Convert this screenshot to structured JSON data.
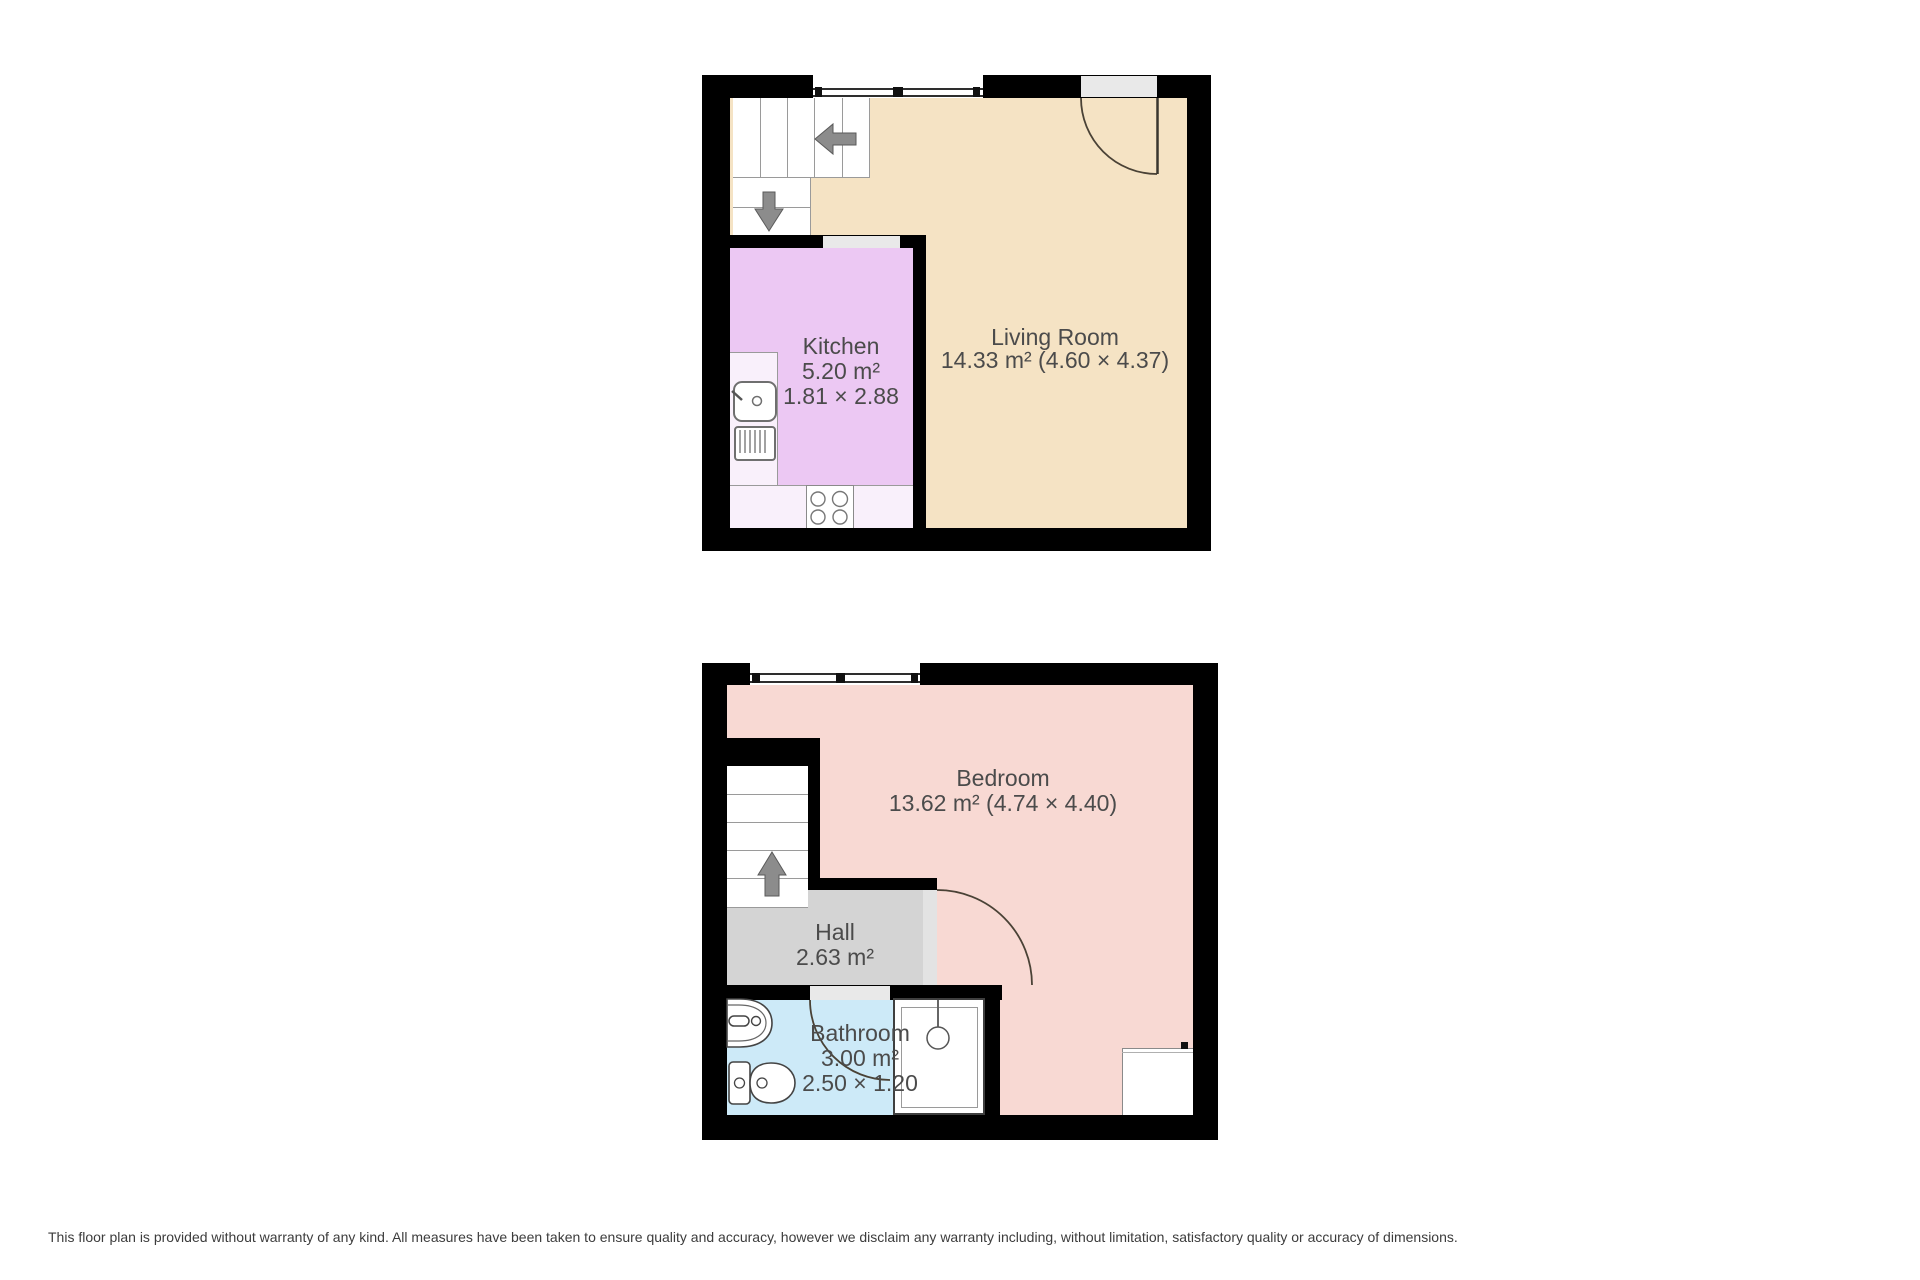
{
  "page": {
    "background": "#ffffff",
    "disclaimer": "This floor plan is provided without warranty of any kind. All measures have been taken to ensure quality and accuracy, however we disclaim any warranty including, without limitation, satisfactory quality or accuracy of dimensions."
  },
  "colors": {
    "wall": "#000000",
    "living_room": "#f5e3c4",
    "kitchen": "#ecc8f3",
    "kitchen_counter": "#f9f0fb",
    "bedroom": "#f8d9d3",
    "hall": "#d4d4d4",
    "bathroom": "#cdeaf8",
    "door_opening": "#e9e9e9",
    "door_leaf": "#e3e3e3",
    "label_text": "#4b4b4b",
    "arrow": "#8c8c8c"
  },
  "floor_upper": {
    "rooms": [
      {
        "name": "Kitchen",
        "area": "5.20 m²",
        "dims": "1.81 × 2.88"
      },
      {
        "name": "Living Room",
        "area_dims": "14.33 m² (4.60 × 4.37)"
      }
    ],
    "stairs": {
      "arrow_1": "left",
      "arrow_2": "down"
    }
  },
  "floor_lower": {
    "rooms": [
      {
        "name": "Bedroom",
        "area_dims": "13.62 m² (4.74 × 4.40)"
      },
      {
        "name": "Hall",
        "area": "2.63 m²"
      },
      {
        "name": "Bathroom",
        "area": "3.00 m²",
        "dims": "2.50 × 1.20"
      }
    ],
    "stairs": {
      "arrow_1": "up"
    }
  }
}
